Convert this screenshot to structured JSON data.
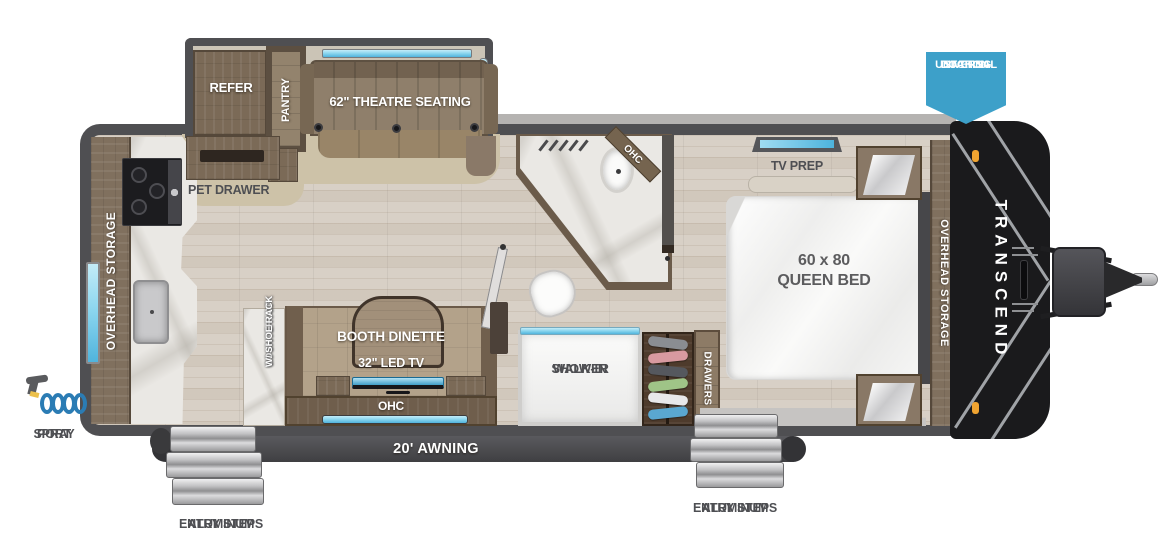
{
  "floorplan": {
    "slide": {
      "refer": "REFER",
      "pantry": "PANTRY",
      "theatre": "62\" THEATRE SEATING"
    },
    "kitchen": {
      "overhead_storage": "OVERHEAD STORAGE",
      "pet_drawer": "PET DRAWER",
      "spray_port": [
        "SPRAY",
        "PORT"
      ],
      "countertop": [
        "COUNTERTOP",
        "W/ SHOE RACK"
      ]
    },
    "dinette": {
      "booth": "BOOTH DINETTE",
      "tv": "32\" LED TV",
      "ohc": "OHC"
    },
    "bath": {
      "ohc": "OHC",
      "shower": [
        "WALK-IN",
        "SHOWER"
      ],
      "drawers": "DRAWERS"
    },
    "bedroom": {
      "tv_prep": "TV PREP",
      "bed_size": "60 x 80",
      "bed_type": "QUEEN BED",
      "overhead_storage": "OVERHEAD STORAGE"
    },
    "exterior": {
      "docking": [
        "UNIVERSAL",
        "DOCKING",
        "STATION"
      ],
      "brand": "TRANSCEND",
      "awning": "20' AWNING",
      "steps": [
        "ALUMINUM",
        "ENTRY STEPS"
      ]
    }
  },
  "colors": {
    "wall_gray": "#4f4f52",
    "window_blue": "#6ec3e4",
    "badge_blue": "#3da0c9",
    "wood_brown": "#7b6a57",
    "carpet_tan": "#cdc2a8",
    "floor_tan": "#d8d0c6",
    "marble": "#eae8e4",
    "cap_black": "#1a1a1c",
    "marker_orange": "#f0a431",
    "step_silver": "#c6c6c8",
    "awning_gray": "#4a4a4e",
    "spray_blue": "#2b7cb4",
    "label_dark": "#4e4f53"
  }
}
